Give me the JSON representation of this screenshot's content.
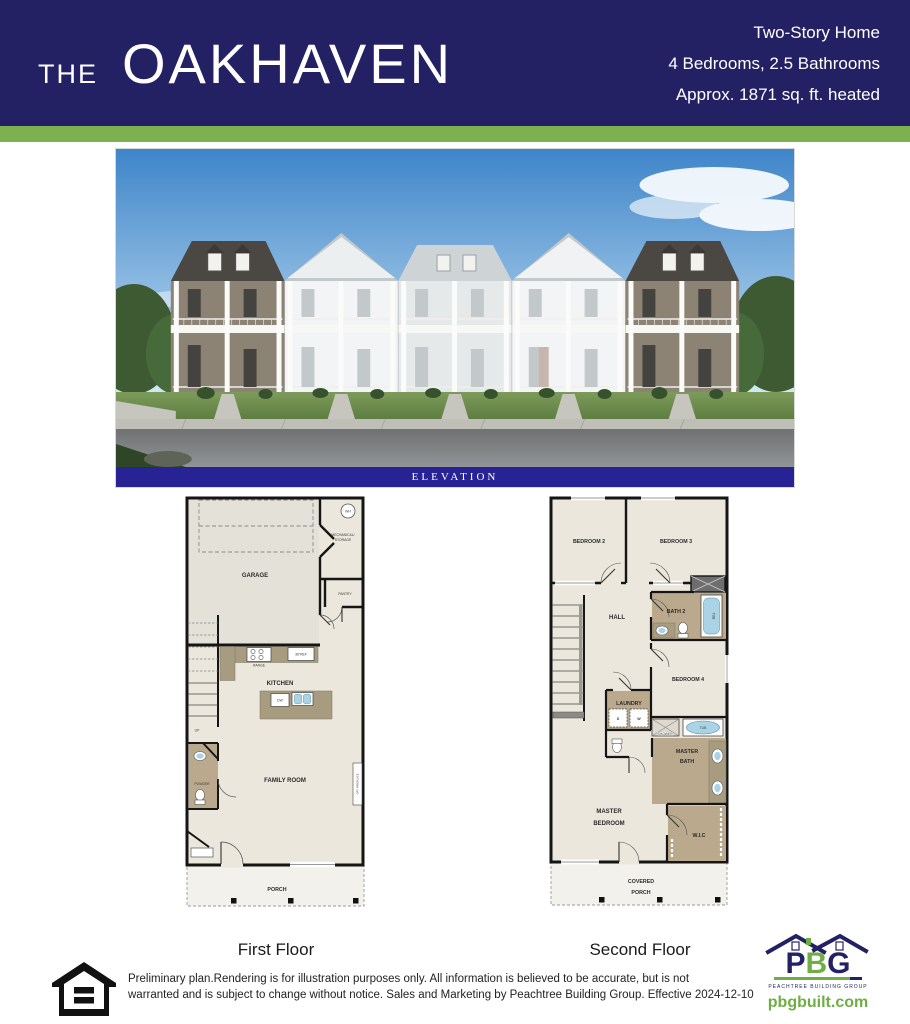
{
  "header": {
    "the": "THE",
    "name": "OAKHAVEN",
    "spec1": "Two-Story Home",
    "spec2": "4 Bedrooms, 2.5 Bathrooms",
    "spec3": "Approx. 1871 sq. ft. heated"
  },
  "elevation": {
    "caption": "ELEVATION"
  },
  "first_floor": {
    "caption": "First Floor",
    "rooms": {
      "garage": "GARAGE",
      "wh": "WH",
      "mech1": "MECHANICAL/",
      "mech2": "STORAGE",
      "pantry": "PANTRY",
      "range": "RANGE",
      "ref": "36\"REF",
      "kitchen": "KITCHEN",
      "dw": "DW",
      "up": "UP",
      "powder": "POWDER",
      "family_room": "FAMILY ROOM",
      "opt_fireplace": "OPT. FIREPLACE",
      "porch": "PORCH"
    }
  },
  "second_floor": {
    "caption": "Second Floor",
    "rooms": {
      "bedroom2": "BEDROOM 2",
      "bedroom3": "BEDROOM 3",
      "hall": "HALL",
      "bath2": "BATH 2",
      "tub": "TUB",
      "bedroom4": "BEDROOM 4",
      "laundry": "LAUNDRY",
      "dryer": "D",
      "washer": "W",
      "shower": "SHOWER",
      "master_tub": "TUB",
      "master_bath1": "MASTER",
      "master_bath2": "BATH",
      "master_bed1": "MASTER",
      "master_bed2": "BEDROOM",
      "wic": "W.I.C",
      "covered_porch1": "COVERED",
      "covered_porch2": "PORCH"
    }
  },
  "footer": {
    "disclaimer_line1": "Preliminary plan.Rendering is for illustration purposes only. All information is believed to be accurate, but is not",
    "disclaimer_line2": "warranted and is subject to change without notice. Sales and Marketing by Peachtree Building Group. Effective 2024-12-10",
    "logo": {
      "p": "P",
      "b": "B",
      "g": "G",
      "tagline": "PEACHTREE BUILDING GROUP",
      "website": "pbgbuilt.com"
    }
  },
  "colors": {
    "navy": "#232164",
    "elevation_bar": "#282394",
    "green_stripe": "#7db04f",
    "logo_green": "#6fae44"
  }
}
